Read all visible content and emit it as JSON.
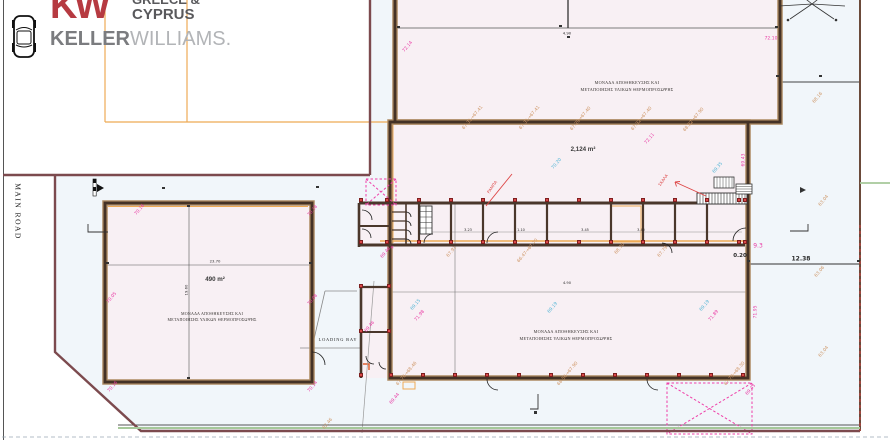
{
  "logo": {
    "kw": "KW",
    "region_line1": "GREECE &",
    "region_line2": "CYPRUS",
    "brand_bold": "KELLER",
    "brand_light": "WILLIAMS."
  },
  "road_label": "MAIN ROAD",
  "plan": {
    "unit_label_line1": "ΜΟΝΑΔΑ ΑΠΟΘΗΚΕΥΣΗΣ ΚΑΙ",
    "unit_label_line2": "ΜΕΤΑΠΟΙΗΣΗΣ ΥΛΙΚΩΝ ΘΕΡΜΟΠΡΟΣΩΨΗΣ",
    "hall_area": "2,124 m²",
    "left_area": "490 m²",
    "loading_bay": "LOADING BAY",
    "annotations": [
      {
        "t": "72.14",
        "x": 408,
        "y": 47,
        "r": -50,
        "c": "pk"
      },
      {
        "t": "72.11",
        "x": 650,
        "y": 139,
        "r": -50,
        "c": "pk"
      },
      {
        "t": "72.10",
        "x": 771,
        "y": 39,
        "r": 0,
        "c": "pk"
      },
      {
        "t": "69.43",
        "x": 744,
        "y": 160,
        "r": -90,
        "c": "pk"
      },
      {
        "t": "9.3",
        "x": 758,
        "y": 246,
        "r": 0,
        "c": "pk",
        "f": 6
      },
      {
        "t": "71.98",
        "x": 420,
        "y": 316,
        "r": -50,
        "c": "pk"
      },
      {
        "t": "71.89",
        "x": 714,
        "y": 316,
        "r": -50,
        "c": "pk"
      },
      {
        "t": "71.95",
        "x": 756,
        "y": 312,
        "r": -90,
        "c": "pk"
      },
      {
        "t": "70.16",
        "x": 140,
        "y": 210,
        "r": -50,
        "c": "pk"
      },
      {
        "t": "70.18",
        "x": 313,
        "y": 211,
        "r": -50,
        "c": "pk"
      },
      {
        "t": "70.05",
        "x": 112,
        "y": 298,
        "r": -50,
        "c": "pk"
      },
      {
        "t": "70.08",
        "x": 313,
        "y": 300,
        "r": -50,
        "c": "pk"
      },
      {
        "t": "70.16",
        "x": 113,
        "y": 387,
        "r": -50,
        "c": "pk"
      },
      {
        "t": "70.14",
        "x": 313,
        "y": 387,
        "r": -50,
        "c": "pk"
      },
      {
        "t": "69.46",
        "x": 370,
        "y": 327,
        "r": -50,
        "c": "pk"
      },
      {
        "t": "69.46",
        "x": 386,
        "y": 253,
        "r": -50,
        "c": "pk"
      },
      {
        "t": "✳",
        "x": 392,
        "y": 248,
        "r": 0,
        "c": "pk",
        "f": 5
      },
      {
        "t": "69.44",
        "x": 395,
        "y": 399,
        "r": -50,
        "c": "pk"
      },
      {
        "t": "69.43",
        "x": 751,
        "y": 390,
        "r": -50,
        "c": "pk"
      },
      {
        "t": "70.20",
        "x": 557,
        "y": 164,
        "r": -50,
        "c": "cy"
      },
      {
        "t": "69.35",
        "x": 718,
        "y": 168,
        "r": -50,
        "c": "cy"
      },
      {
        "t": "69.19",
        "x": 553,
        "y": 308,
        "r": -50,
        "c": "cy"
      },
      {
        "t": "69.19",
        "x": 705,
        "y": 306,
        "r": -50,
        "c": "cy"
      },
      {
        "t": "69.15",
        "x": 416,
        "y": 305,
        "r": -50,
        "c": "cy"
      },
      {
        "t": "67.31→67.41",
        "x": 473,
        "y": 118,
        "r": -50,
        "c": "tn"
      },
      {
        "t": "67.31→67.41",
        "x": 530,
        "y": 118,
        "r": -50,
        "c": "tn"
      },
      {
        "t": "67.29→67.40",
        "x": 581,
        "y": 119,
        "r": -50,
        "c": "tn"
      },
      {
        "t": "67.32→67.40",
        "x": 642,
        "y": 119,
        "r": -50,
        "c": "tn"
      },
      {
        "t": "68.02→67.90",
        "x": 694,
        "y": 120,
        "r": -50,
        "c": "tn"
      },
      {
        "t": "68.16",
        "x": 818,
        "y": 98,
        "r": -50,
        "c": "tn"
      },
      {
        "t": "63.04",
        "x": 824,
        "y": 201,
        "r": -50,
        "c": "tn"
      },
      {
        "t": "63.06",
        "x": 820,
        "y": 272,
        "r": -50,
        "c": "tn"
      },
      {
        "t": "63.04",
        "x": 824,
        "y": 352,
        "r": -50,
        "c": "tn"
      },
      {
        "t": "67.76→68.46",
        "x": 407,
        "y": 374,
        "r": -50,
        "c": "tn"
      },
      {
        "t": "68.56→67.90",
        "x": 568,
        "y": 374,
        "r": -50,
        "c": "tn"
      },
      {
        "t": "67.79→68.30",
        "x": 735,
        "y": 374,
        "r": -50,
        "c": "tn"
      },
      {
        "t": "67.91",
        "x": 452,
        "y": 252,
        "r": -50,
        "c": "tn"
      },
      {
        "t": "66.47→67.70",
        "x": 528,
        "y": 251,
        "r": -50,
        "c": "tn"
      },
      {
        "t": "68.70",
        "x": 620,
        "y": 249,
        "r": -50,
        "c": "tn"
      },
      {
        "t": "67.79",
        "x": 663,
        "y": 252,
        "r": -50,
        "c": "tn"
      },
      {
        "t": "62.46",
        "x": 328,
        "y": 424,
        "r": -50,
        "c": "tn"
      },
      {
        "t": "ΣΚΑΛΑ",
        "x": 663,
        "y": 180,
        "r": -55,
        "c": "rd",
        "f": 4
      },
      {
        "t": "ΡΑΜΠΑ",
        "x": 492,
        "y": 187,
        "r": -55,
        "c": "rd",
        "f": 4
      },
      {
        "t": "4.90",
        "x": 567,
        "y": 33,
        "r": 0,
        "c": "bk",
        "f": 3.8
      },
      {
        "t": "4.90",
        "x": 567,
        "y": 283,
        "r": 0,
        "c": "bk",
        "f": 3.6
      },
      {
        "t": "3.23",
        "x": 468,
        "y": 230,
        "r": 0,
        "c": "bk",
        "f": 3.5
      },
      {
        "t": "1.10",
        "x": 521,
        "y": 230,
        "r": 0,
        "c": "bk",
        "f": 3.5
      },
      {
        "t": "3.45",
        "x": 585,
        "y": 230,
        "r": 0,
        "c": "bk",
        "f": 3.5
      },
      {
        "t": "3.40",
        "x": 641,
        "y": 230,
        "r": 0,
        "c": "bk",
        "f": 3.5
      },
      {
        "t": "12.38",
        "x": 801,
        "y": 259,
        "r": 0,
        "c": "bk",
        "f": 6,
        "b": 1
      },
      {
        "t": "0.20",
        "x": 740,
        "y": 256,
        "r": 0,
        "c": "bk",
        "f": 5.5,
        "b": 1
      },
      {
        "t": "23.70",
        "x": 215,
        "y": 261,
        "r": 0,
        "c": "bk",
        "f": 3.8
      },
      {
        "t": "19.60",
        "x": 186,
        "y": 290,
        "r": -90,
        "c": "bk",
        "f": 3.8
      }
    ],
    "columns": {
      "rows": [
        {
          "y": 200,
          "xs": [
            387,
            419,
            451,
            483,
            515,
            547,
            579,
            611,
            643,
            675,
            707,
            739
          ]
        },
        {
          "y": 242,
          "xs": [
            387,
            419,
            451,
            483,
            515,
            547,
            579,
            611,
            643,
            675,
            707,
            739
          ]
        },
        {
          "y": 375,
          "xs": [
            391,
            423,
            455,
            487,
            519,
            551,
            583,
            615,
            647,
            679,
            711,
            743
          ]
        }
      ],
      "extras": [
        [
          361,
          200
        ],
        [
          361,
          242
        ],
        [
          361,
          286
        ],
        [
          389,
          286
        ],
        [
          361,
          331
        ],
        [
          389,
          331
        ],
        [
          361,
          375
        ],
        [
          745,
          200
        ],
        [
          745,
          242
        ]
      ]
    },
    "ticks": [
      [
        560,
        26
      ],
      [
        568,
        37
      ],
      [
        777,
        76
      ],
      [
        820,
        76
      ],
      [
        398,
        27
      ],
      [
        776,
        27
      ],
      [
        107,
        263
      ],
      [
        310,
        263
      ],
      [
        188,
        206
      ],
      [
        188,
        378
      ],
      [
        163,
        188
      ],
      [
        317,
        187
      ],
      [
        748,
        261
      ],
      [
        858,
        261
      ]
    ]
  }
}
